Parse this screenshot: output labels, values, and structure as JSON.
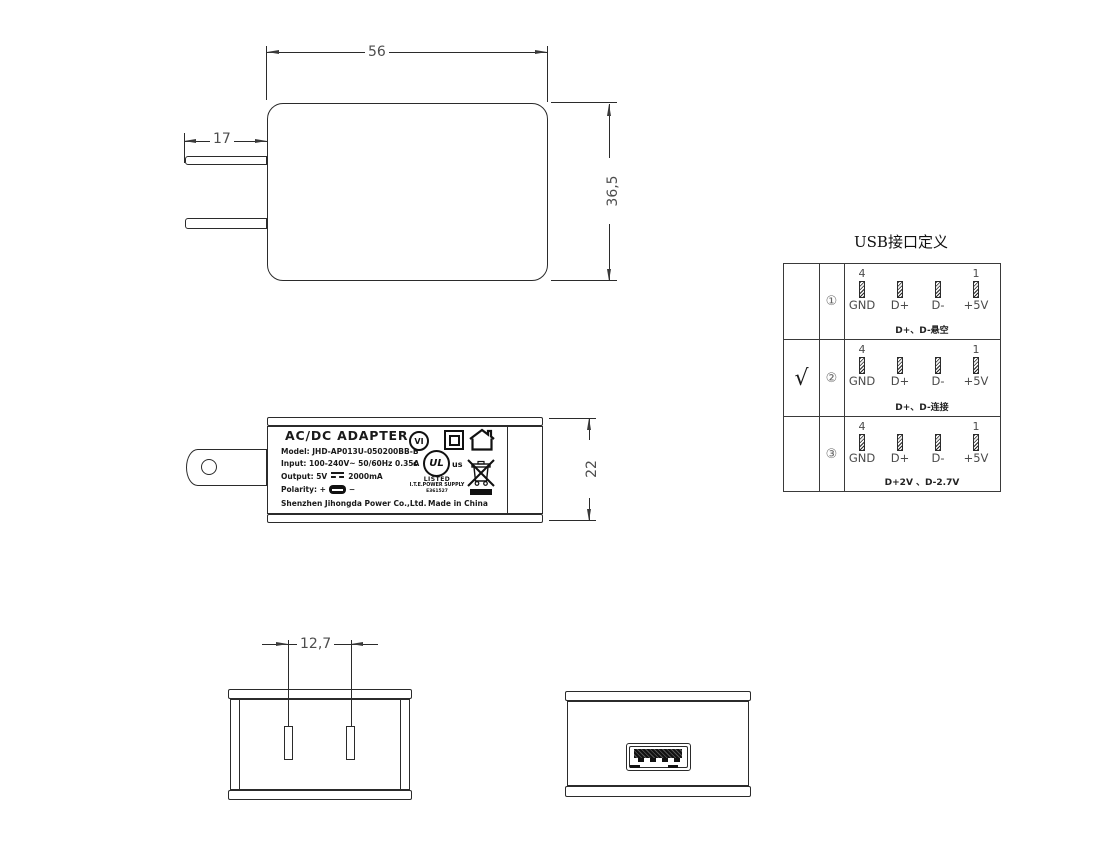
{
  "drawing": {
    "front_view": {
      "width_dim": "56",
      "height_dim": "36,5",
      "prong_dim": "17"
    },
    "side_view": {
      "height_dim": "22",
      "label": {
        "title": "AC/DC  ADAPTER",
        "model": "Model: JHD-AP013U-050200BB-B",
        "input": "Input: 100-240V~  50/60Hz  0.35A",
        "output_prefix": "Output: 5V",
        "output_suffix": "2000mA",
        "polarity_prefix": "Polarity: +",
        "polarity_suffix": "−",
        "manufacturer": "Shenzhen Jihongda Power Co.,Ltd.",
        "made_in": "Made in China",
        "marks": {
          "efficiency": "VI",
          "ul_letters": "UL",
          "ul_c": "c",
          "ul_us": "us",
          "listed": "LISTED",
          "ite": "I.T.E.POWER SUPPLY",
          "file_no": "E361527"
        }
      }
    },
    "bottom_view": {
      "pin_spacing_dim": "12,7"
    },
    "usb_table": {
      "title": "USB接口定义",
      "pin4": "4",
      "pin1": "1",
      "pin_labels": [
        "GND",
        "D+",
        "D-",
        "+5V"
      ],
      "rows": [
        {
          "selected": "",
          "num": "①",
          "note": "D+、D-悬空"
        },
        {
          "selected": "√",
          "num": "②",
          "note": "D+、D-连接"
        },
        {
          "selected": "",
          "num": "③",
          "note": "D+2V 、D-2.7V"
        }
      ]
    }
  },
  "colors": {
    "line": "#2b2b2b",
    "dim_text": "#4d4d4d",
    "background": "#ffffff"
  }
}
